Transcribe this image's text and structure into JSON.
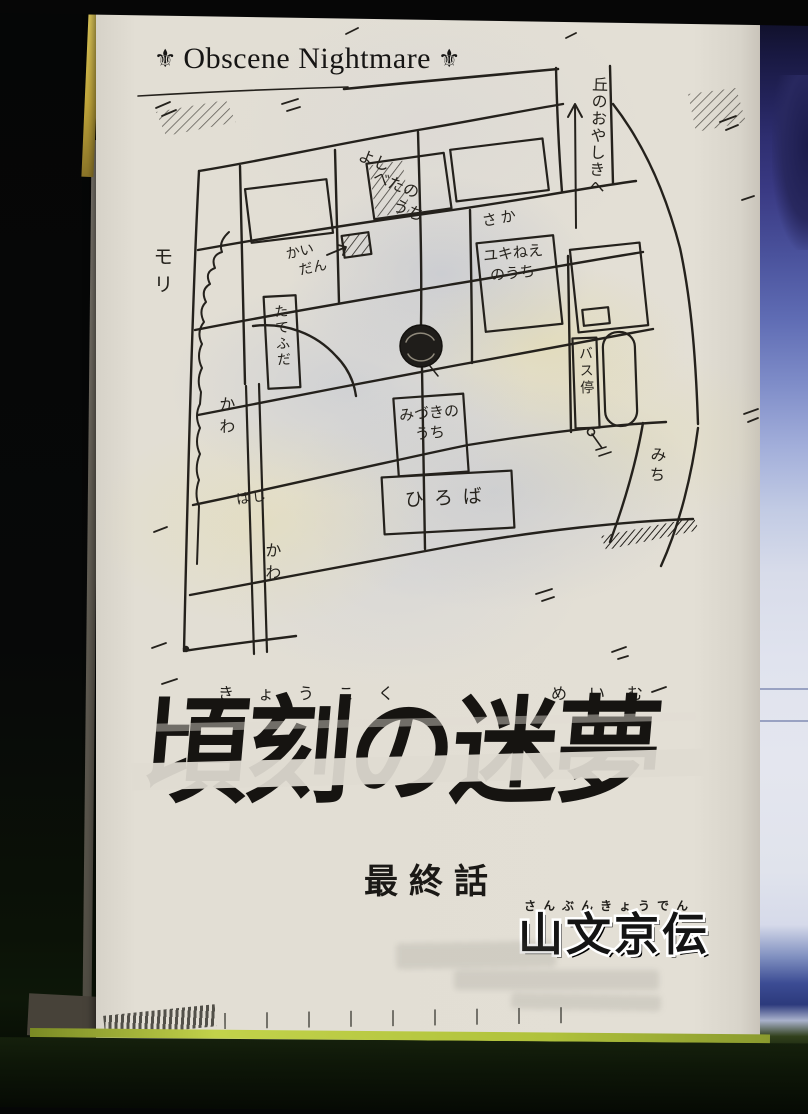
{
  "header": {
    "ornament_glyph": "⚜",
    "title": "Obscene Nightmare"
  },
  "map": {
    "labels": {
      "hill_mansion": "丘のおやしきへ",
      "yoshibeta_house": [
        "よし",
        "べたの",
        "うち"
      ],
      "slope": "さか",
      "stairs": [
        "かい",
        "だん"
      ],
      "yuki_house": [
        "ユキねえ",
        "のうち"
      ],
      "signboard": "たてふだ",
      "bus_stop": "バス停",
      "mizuki_house": [
        "みづきの",
        "うち"
      ],
      "plaza": "ひろば",
      "road": "みち",
      "forest": "モリ",
      "river_upper": "かわ",
      "river_lower": "かわ",
      "bridge": "はし"
    }
  },
  "title_block": {
    "furigana_left": "きょうこく",
    "furigana_right": "めいむ",
    "title": "頃刻の迷夢",
    "chapter": "最終話"
  },
  "author": {
    "furigana": "さんぶんきょうでん",
    "name": "山文京伝"
  },
  "palette": {
    "paper": "#e0dcd2",
    "ink": "#24211c",
    "page_edge_green": "#b5c63f",
    "neighbor_page_blue": "#5f6cb4",
    "scan_background": "#070808"
  }
}
